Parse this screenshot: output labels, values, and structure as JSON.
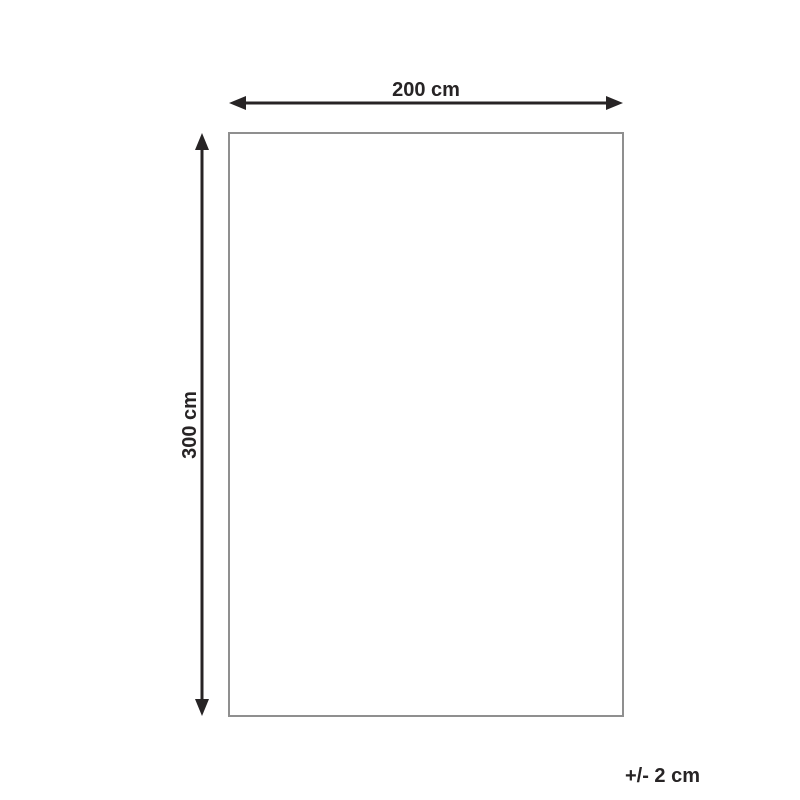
{
  "diagram": {
    "title": "product-dimension-diagram",
    "width_label": "200 cm",
    "height_label": "300 cm",
    "tolerance_label": "+/- 2 cm",
    "width_cm": 200,
    "height_cm": 300,
    "tolerance_cm": 2
  },
  "colors": {
    "background": "#ffffff",
    "arrow": "#272425",
    "text": "#272425",
    "shape_border": "#8f8f8f",
    "shape_fill": "#ffffff"
  }
}
